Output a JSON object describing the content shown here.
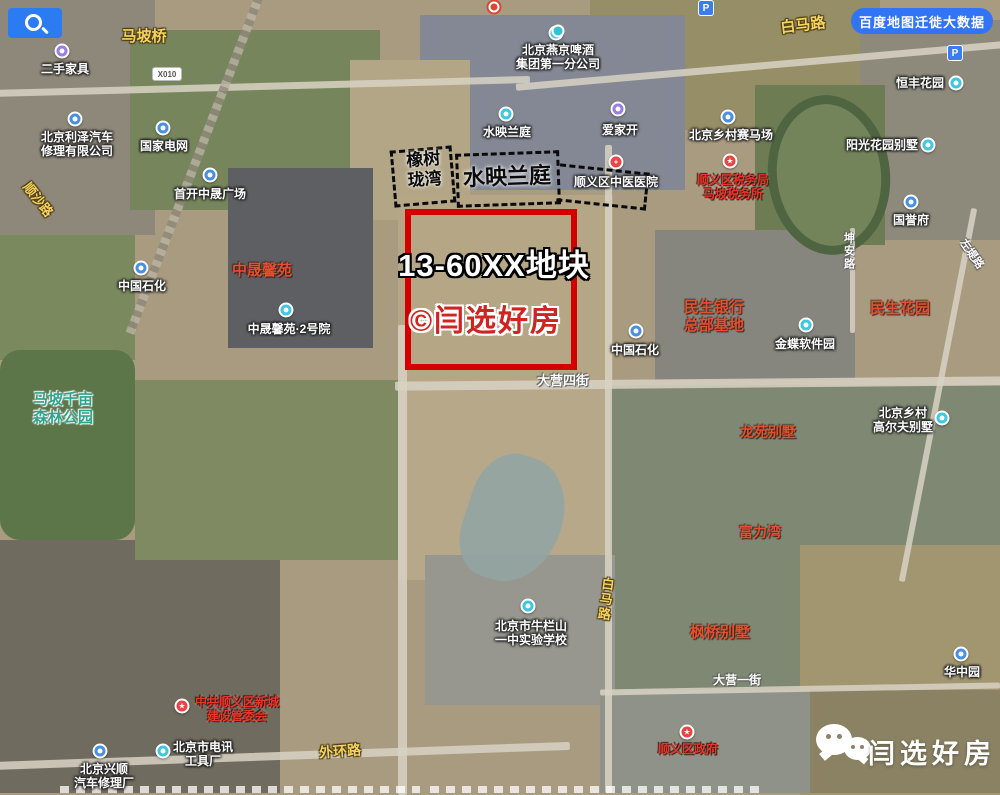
{
  "toolbar": {
    "migration_button": "百度地图迁徙大数据"
  },
  "plot": {
    "id_label": "13-60XX地块",
    "watermark": "©闫选好房"
  },
  "footer": {
    "brand": "闫选好房"
  },
  "colors": {
    "plot_frame": "#d40000",
    "accent_blue": "#3174f5",
    "poi_blue": "#4a90e2",
    "poi_cyan": "#3fc6e0",
    "poi_purple": "#9b7ce0",
    "poi_red": "#e84444",
    "road_label_yellow": "#f6d35e",
    "community_red": "#e2502f",
    "park_teal": "#2fa38c"
  },
  "dashed_areas": [
    {
      "name": "橡树珑湾"
    },
    {
      "name": "水映兰庭"
    }
  ],
  "map_labels": [
    {
      "id": "mapo-bridge",
      "style": "road-y",
      "x": 144,
      "y": 28,
      "fs": 15,
      "lines": [
        "马坡桥"
      ]
    },
    {
      "id": "baima-road-top",
      "style": "road-y",
      "x": 803,
      "y": 17,
      "fs": 15,
      "rotate": -7,
      "lines": [
        "白马路"
      ]
    },
    {
      "id": "shunsha-road",
      "style": "road-y",
      "x": 38,
      "y": 192,
      "fs": 13,
      "rotate": 52,
      "lines": [
        "顺沙路"
      ]
    },
    {
      "id": "ershou-furniture",
      "style": "poi",
      "x": 65,
      "y": 62,
      "lines": [
        "二手家具"
      ],
      "icon": {
        "kind": "dot",
        "color": "#9b7ce0",
        "ix": 62,
        "iy": 51
      }
    },
    {
      "id": "lize-auto-repair",
      "style": "poi",
      "x": 77,
      "y": 130,
      "lines": [
        "北京利泽汽车",
        "修理有限公司"
      ],
      "icon": {
        "kind": "dot",
        "color": "#4a90e2",
        "ix": 75,
        "iy": 119
      }
    },
    {
      "id": "state-grid",
      "style": "poi",
      "x": 164,
      "y": 139,
      "lines": [
        "国家电网"
      ],
      "icon": {
        "kind": "dot",
        "color": "#4a90e2",
        "ix": 163,
        "iy": 128
      }
    },
    {
      "id": "shoukai-plaza",
      "style": "poi",
      "x": 210,
      "y": 187,
      "lines": [
        "首开中晟广场"
      ],
      "icon": {
        "kind": "dot",
        "color": "#4a90e2",
        "ix": 210,
        "iy": 175
      }
    },
    {
      "id": "yanjing-beer",
      "style": "poi",
      "x": 558,
      "y": 43,
      "lines": [
        "北京燕京啤酒",
        "集团第一分公司"
      ],
      "icon": {
        "kind": "dot",
        "color": "#3fc6e0",
        "ix": 556,
        "iy": 33
      }
    },
    {
      "id": "shuiying-lanting-poi",
      "style": "poi",
      "x": 507,
      "y": 125,
      "lines": [
        "水映兰庭"
      ],
      "icon": {
        "kind": "dot",
        "color": "#3fc6e0",
        "ix": 506,
        "iy": 114
      }
    },
    {
      "id": "aijiakai",
      "style": "poi",
      "x": 620,
      "y": 123,
      "lines": [
        "爱家开"
      ],
      "icon": {
        "kind": "dot",
        "color": "#9b7ce0",
        "ix": 618,
        "iy": 109
      }
    },
    {
      "id": "tcm-hospital",
      "style": "poi",
      "x": 616,
      "y": 175,
      "lines": [
        "顺义区中医医院"
      ],
      "icon": {
        "kind": "cross",
        "color": "#e84444",
        "ix": 616,
        "iy": 162
      }
    },
    {
      "id": "hengfeng-garden",
      "style": "poi",
      "x": 920,
      "y": 76,
      "lines": [
        "恒丰花园"
      ],
      "icon": {
        "kind": "dot",
        "color": "#3fc6e0",
        "ix": 956,
        "iy": 83
      }
    },
    {
      "id": "countryside-racecourse",
      "style": "poi",
      "x": 731,
      "y": 128,
      "lines": [
        "北京乡村赛马场"
      ],
      "icon": {
        "kind": "dot",
        "color": "#4a90e2",
        "ix": 728,
        "iy": 117
      }
    },
    {
      "id": "mapo-tax-office",
      "style": "red-poi",
      "x": 733,
      "y": 173,
      "fs": 12,
      "lines": [
        "顺义区税务局",
        "马坡税务所"
      ],
      "icon": {
        "kind": "star",
        "color": "#e84444",
        "ix": 730,
        "iy": 161
      }
    },
    {
      "id": "sunshine-garden-villa",
      "style": "poi",
      "x": 882,
      "y": 138,
      "lines": [
        "阳光花园别墅"
      ],
      "icon": {
        "kind": "dot",
        "color": "#3fc6e0",
        "ix": 928,
        "iy": 145
      }
    },
    {
      "id": "guoyufu",
      "style": "poi",
      "x": 911,
      "y": 213,
      "lines": [
        "国誉府"
      ],
      "icon": {
        "kind": "dot",
        "color": "#4a90e2",
        "ix": 911,
        "iy": 202
      }
    },
    {
      "id": "sinopec-west",
      "style": "poi",
      "x": 142,
      "y": 279,
      "lines": [
        "中国石化"
      ],
      "icon": {
        "kind": "dot",
        "color": "#4a90e2",
        "ix": 141,
        "iy": 268
      }
    },
    {
      "id": "zhongsheng-xinyuan",
      "style": "red",
      "x": 262,
      "y": 262,
      "fs": 15,
      "lines": [
        "中晟馨苑"
      ]
    },
    {
      "id": "zhongsheng-no2-yard",
      "style": "poi",
      "x": 289,
      "y": 322,
      "lines": [
        "中晟馨苑·2号院"
      ],
      "icon": {
        "kind": "dot",
        "color": "#3fc6e0",
        "ix": 286,
        "iy": 310
      }
    },
    {
      "id": "mapo-forest-park",
      "style": "teal",
      "x": 63,
      "y": 391,
      "fs": 15,
      "lines": [
        "马坡千亩",
        "森林公园"
      ]
    },
    {
      "id": "minsheng-bank-hq",
      "style": "red",
      "x": 714,
      "y": 299,
      "fs": 15,
      "lines": [
        "民生银行",
        "总部基地"
      ]
    },
    {
      "id": "kingdee-software-park",
      "style": "poi",
      "x": 805,
      "y": 337,
      "lines": [
        "金蝶软件园"
      ],
      "icon": {
        "kind": "dot",
        "color": "#3fc6e0",
        "ix": 806,
        "iy": 325
      }
    },
    {
      "id": "minsheng-garden",
      "style": "red",
      "x": 900,
      "y": 300,
      "fs": 15,
      "lines": [
        "民生花园"
      ]
    },
    {
      "id": "sinopec-mid",
      "style": "poi",
      "x": 635,
      "y": 343,
      "lines": [
        "中国石化"
      ],
      "icon": {
        "kind": "dot",
        "color": "#4a90e2",
        "ix": 636,
        "iy": 331
      }
    },
    {
      "id": "kunan-road",
      "style": "road-w",
      "x": 848,
      "y": 232,
      "fs": 11,
      "vertical": true,
      "lines": [
        "坤安路"
      ]
    },
    {
      "id": "zuodi-road",
      "style": "road-w",
      "x": 971,
      "y": 248,
      "fs": 11,
      "rotate": 55,
      "lines": [
        "左堤路"
      ]
    },
    {
      "id": "daying-4th-street",
      "style": "road-w",
      "x": 563,
      "y": 373,
      "fs": 13,
      "lines": [
        "大营四街"
      ]
    },
    {
      "id": "longyuan-villa",
      "style": "red",
      "x": 768,
      "y": 424,
      "fs": 14,
      "lines": [
        "龙苑别墅"
      ]
    },
    {
      "id": "countryside-golf-villa",
      "style": "poi",
      "x": 903,
      "y": 406,
      "lines": [
        "北京乡村",
        "高尔夫别墅"
      ],
      "icon": {
        "kind": "dot",
        "color": "#3fc6e0",
        "ix": 942,
        "iy": 418
      }
    },
    {
      "id": "fuliwan",
      "style": "red",
      "x": 760,
      "y": 524,
      "fs": 14,
      "lines": [
        "富力湾"
      ]
    },
    {
      "id": "baima-road-south",
      "style": "road-y",
      "x": 605,
      "y": 577,
      "fs": 13,
      "vertical": true,
      "rotate": 7,
      "lines": [
        "白马路"
      ]
    },
    {
      "id": "fengqiao-villa",
      "style": "red",
      "x": 720,
      "y": 624,
      "fs": 15,
      "lines": [
        "枫桥别墅"
      ]
    },
    {
      "id": "niulanshan-school",
      "style": "poi",
      "x": 531,
      "y": 619,
      "lines": [
        "北京市牛栏山",
        "一中实验学校"
      ],
      "icon": {
        "kind": "dot",
        "color": "#3fc6e0",
        "ix": 528,
        "iy": 606
      }
    },
    {
      "id": "huazhong-garden",
      "style": "poi",
      "x": 962,
      "y": 665,
      "lines": [
        "华中园"
      ],
      "icon": {
        "kind": "dot",
        "color": "#4a90e2",
        "ix": 961,
        "iy": 654
      }
    },
    {
      "id": "xincheng-committee",
      "style": "red-poi",
      "x": 237,
      "y": 695,
      "fs": 12,
      "lines": [
        "中共顺义区新城",
        "建设管委会"
      ],
      "icon": {
        "kind": "star",
        "color": "#e84444",
        "ix": 182,
        "iy": 706
      }
    },
    {
      "id": "telecom-tool-factory",
      "style": "poi",
      "x": 203,
      "y": 740,
      "lines": [
        "北京市电讯",
        "工具厂"
      ],
      "icon": {
        "kind": "dot",
        "color": "#3fc6e0",
        "ix": 163,
        "iy": 751
      }
    },
    {
      "id": "xingshun-auto-repair",
      "style": "poi",
      "x": 104,
      "y": 762,
      "lines": [
        "北京兴顺",
        "汽车修理厂"
      ],
      "icon": {
        "kind": "dot",
        "color": "#4a90e2",
        "ix": 100,
        "iy": 751
      }
    },
    {
      "id": "waihuan-road",
      "style": "road-y",
      "x": 340,
      "y": 743,
      "fs": 14,
      "rotate": -4,
      "lines": [
        "外环路"
      ]
    },
    {
      "id": "shunyi-district-gov",
      "style": "red-poi",
      "x": 688,
      "y": 742,
      "fs": 12,
      "lines": [
        "顺义区政府"
      ],
      "icon": {
        "kind": "star",
        "color": "#e84444",
        "ix": 687,
        "iy": 732
      }
    },
    {
      "id": "daying-1st-street",
      "style": "road-w",
      "x": 737,
      "y": 673,
      "fs": 12,
      "lines": [
        "大营一街"
      ]
    },
    {
      "id": "plot-id",
      "style": "plot-white",
      "x": 494,
      "y": 248,
      "fs": 31,
      "lines": [
        "13-60XX地块"
      ]
    },
    {
      "id": "plot-watermark",
      "style": "plot-red",
      "x": 486,
      "y": 304,
      "fs": 30,
      "lines": [
        "©闫选好房"
      ]
    },
    {
      "id": "xiangshu-longwan-area",
      "style": "black",
      "x": 424,
      "y": 150,
      "fs": 17,
      "rotate": -4,
      "lines": [
        "橡树",
        "珑湾"
      ]
    },
    {
      "id": "shuiying-lanting-area",
      "style": "black",
      "x": 507,
      "y": 164,
      "fs": 22,
      "rotate": -2,
      "lines": [
        "水映兰庭"
      ]
    }
  ],
  "badges": [
    {
      "kind": "shield",
      "text": "X010",
      "x": 167,
      "y": 74,
      "name": "road-shield-x010"
    },
    {
      "kind": "p",
      "text": "P",
      "x": 955,
      "y": 53,
      "name": "parking-icon"
    },
    {
      "kind": "p",
      "text": "P",
      "x": 706,
      "y": 8,
      "name": "parking-icon"
    },
    {
      "kind": "bullseye",
      "text": "",
      "x": 494,
      "y": 7,
      "name": "panorama-target-icon"
    },
    {
      "kind": "teal-dot",
      "text": "",
      "x": 558,
      "y": 31,
      "name": "poi-dot-icon"
    }
  ]
}
